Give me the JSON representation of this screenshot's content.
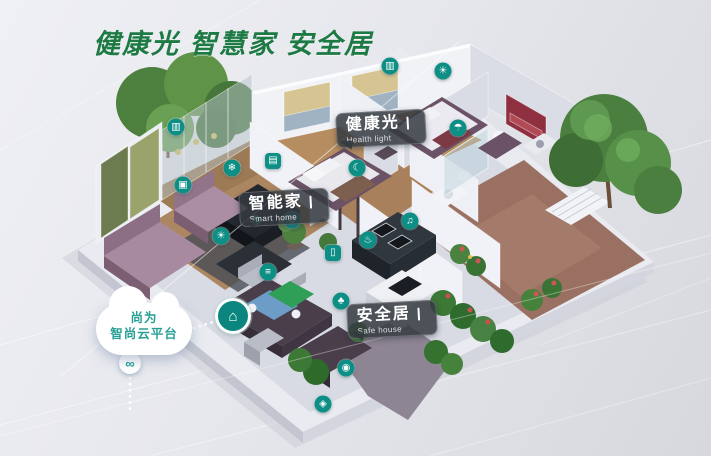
{
  "title": {
    "text": "健康光 智慧家 安全居"
  },
  "chips": [
    {
      "id": "health_light",
      "zh": "健康光",
      "en": "Health light"
    },
    {
      "id": "smart_home",
      "zh": "智能家",
      "en": "Smart home"
    },
    {
      "id": "safe_house",
      "zh": "安全居",
      "en": "Safe house"
    }
  ],
  "cloud": {
    "line1": "尚为",
    "line2": "智尚云平台"
  },
  "colors": {
    "title_green": "#1E7A44",
    "icon_teal": "#0E8F86",
    "chip_bg": "rgba(52,57,64,0.85)",
    "cloud_text": "#2AA095"
  },
  "icons": [
    {
      "name": "curtain-blind-icon",
      "glyph": "▥",
      "x": 390,
      "y": 66,
      "shape": "circle"
    },
    {
      "name": "ceiling-light-icon",
      "glyph": "☀",
      "x": 443,
      "y": 71,
      "shape": "circle"
    },
    {
      "name": "humidity-sensor-icon",
      "glyph": "☂",
      "x": 458,
      "y": 128,
      "shape": "circle"
    },
    {
      "name": "curtain-icon",
      "glyph": "▥",
      "x": 176,
      "y": 127,
      "shape": "circle"
    },
    {
      "name": "switch-panel-icon",
      "glyph": "▤",
      "x": 273,
      "y": 161,
      "shape": "square"
    },
    {
      "name": "ac-icon",
      "glyph": "❄",
      "x": 232,
      "y": 168,
      "shape": "circle"
    },
    {
      "name": "tv-icon",
      "glyph": "▣",
      "x": 183,
      "y": 185,
      "shape": "circle"
    },
    {
      "name": "sleep-monitor-icon",
      "glyph": "☾",
      "x": 357,
      "y": 168,
      "shape": "circle"
    },
    {
      "name": "thermostat-icon",
      "glyph": "⚙",
      "x": 292,
      "y": 220,
      "shape": "circle"
    },
    {
      "name": "lamp-icon",
      "glyph": "☀",
      "x": 221,
      "y": 236,
      "shape": "circle"
    },
    {
      "name": "air-quality-icon",
      "glyph": "≡",
      "x": 268,
      "y": 272,
      "shape": "circle"
    },
    {
      "name": "door-sensor-icon",
      "glyph": "▯",
      "x": 333,
      "y": 253,
      "shape": "square"
    },
    {
      "name": "gas-sensor-icon",
      "glyph": "♨",
      "x": 368,
      "y": 240,
      "shape": "circle"
    },
    {
      "name": "speaker-icon",
      "glyph": "♫",
      "x": 410,
      "y": 221,
      "shape": "circle"
    },
    {
      "name": "plant-sensor-icon",
      "glyph": "♣",
      "x": 341,
      "y": 301,
      "shape": "circle"
    },
    {
      "name": "camera-icon",
      "glyph": "◉",
      "x": 346,
      "y": 368,
      "shape": "circle"
    },
    {
      "name": "door-lock-icon",
      "glyph": "◈",
      "x": 323,
      "y": 404,
      "shape": "circle"
    },
    {
      "name": "gateway-hub-icon",
      "glyph": "⌂",
      "x": 233,
      "y": 316,
      "shape": "hub"
    },
    {
      "name": "cloud-link-icon",
      "glyph": "∞",
      "x": 130,
      "y": 363,
      "shape": "white"
    }
  ]
}
